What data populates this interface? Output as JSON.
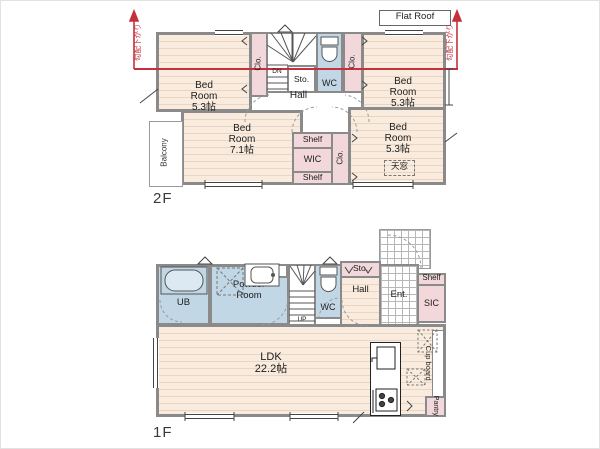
{
  "meta": {
    "type": "floor-plan",
    "colors": {
      "accent_red": "#c4303b",
      "wall_gray": "#8a8a8a",
      "floor_beige": "#f9ecdf",
      "closet_pink": "#f2d7db",
      "wet_area_blue": "#c2d7e6"
    },
    "icons": [
      "toilet-icon",
      "bathtub-icon",
      "sink-icon",
      "stove-icon",
      "stairs-icon",
      "washer-space-icon",
      "slope-arrow-icon",
      "window-icon",
      "door-arc-icon"
    ]
  },
  "f2": {
    "floor_label": "2F",
    "flat_roof": "Flat Roof",
    "slope_left": "勾配下がり",
    "slope_right": "勾配下がり",
    "bed_tl": "Bed\nRoom\n5.3帖",
    "bed_tr": "Bed\nRoom\n5.3帖",
    "bed_bl": "Bed\nRoom\n7.1帖",
    "bed_br": "Bed\nRoom\n5.3帖",
    "clo_left": "Clo.",
    "clo_right": "Clo.",
    "clo_mid": "Clo.",
    "dn": "DN",
    "sto": "Sto.",
    "wc": "WC",
    "hall": "Hall",
    "balcony": "Balcony",
    "shelf_top": "Shelf",
    "wic": "WIC",
    "shelf_bottom": "Shelf",
    "skylight": "天窓"
  },
  "f1": {
    "floor_label": "1F",
    "ub": "UB",
    "powder": "Powder\nRoom",
    "ds": "DS",
    "up": "UP",
    "wc": "WC",
    "sto": "Sto.",
    "hall": "Hall",
    "ent": "Ent.",
    "shelf": "Shelf",
    "sic": "SIC",
    "ldk": "LDK\n22.2帖",
    "cupboard": "Cup board",
    "pantry": "Pantry"
  }
}
